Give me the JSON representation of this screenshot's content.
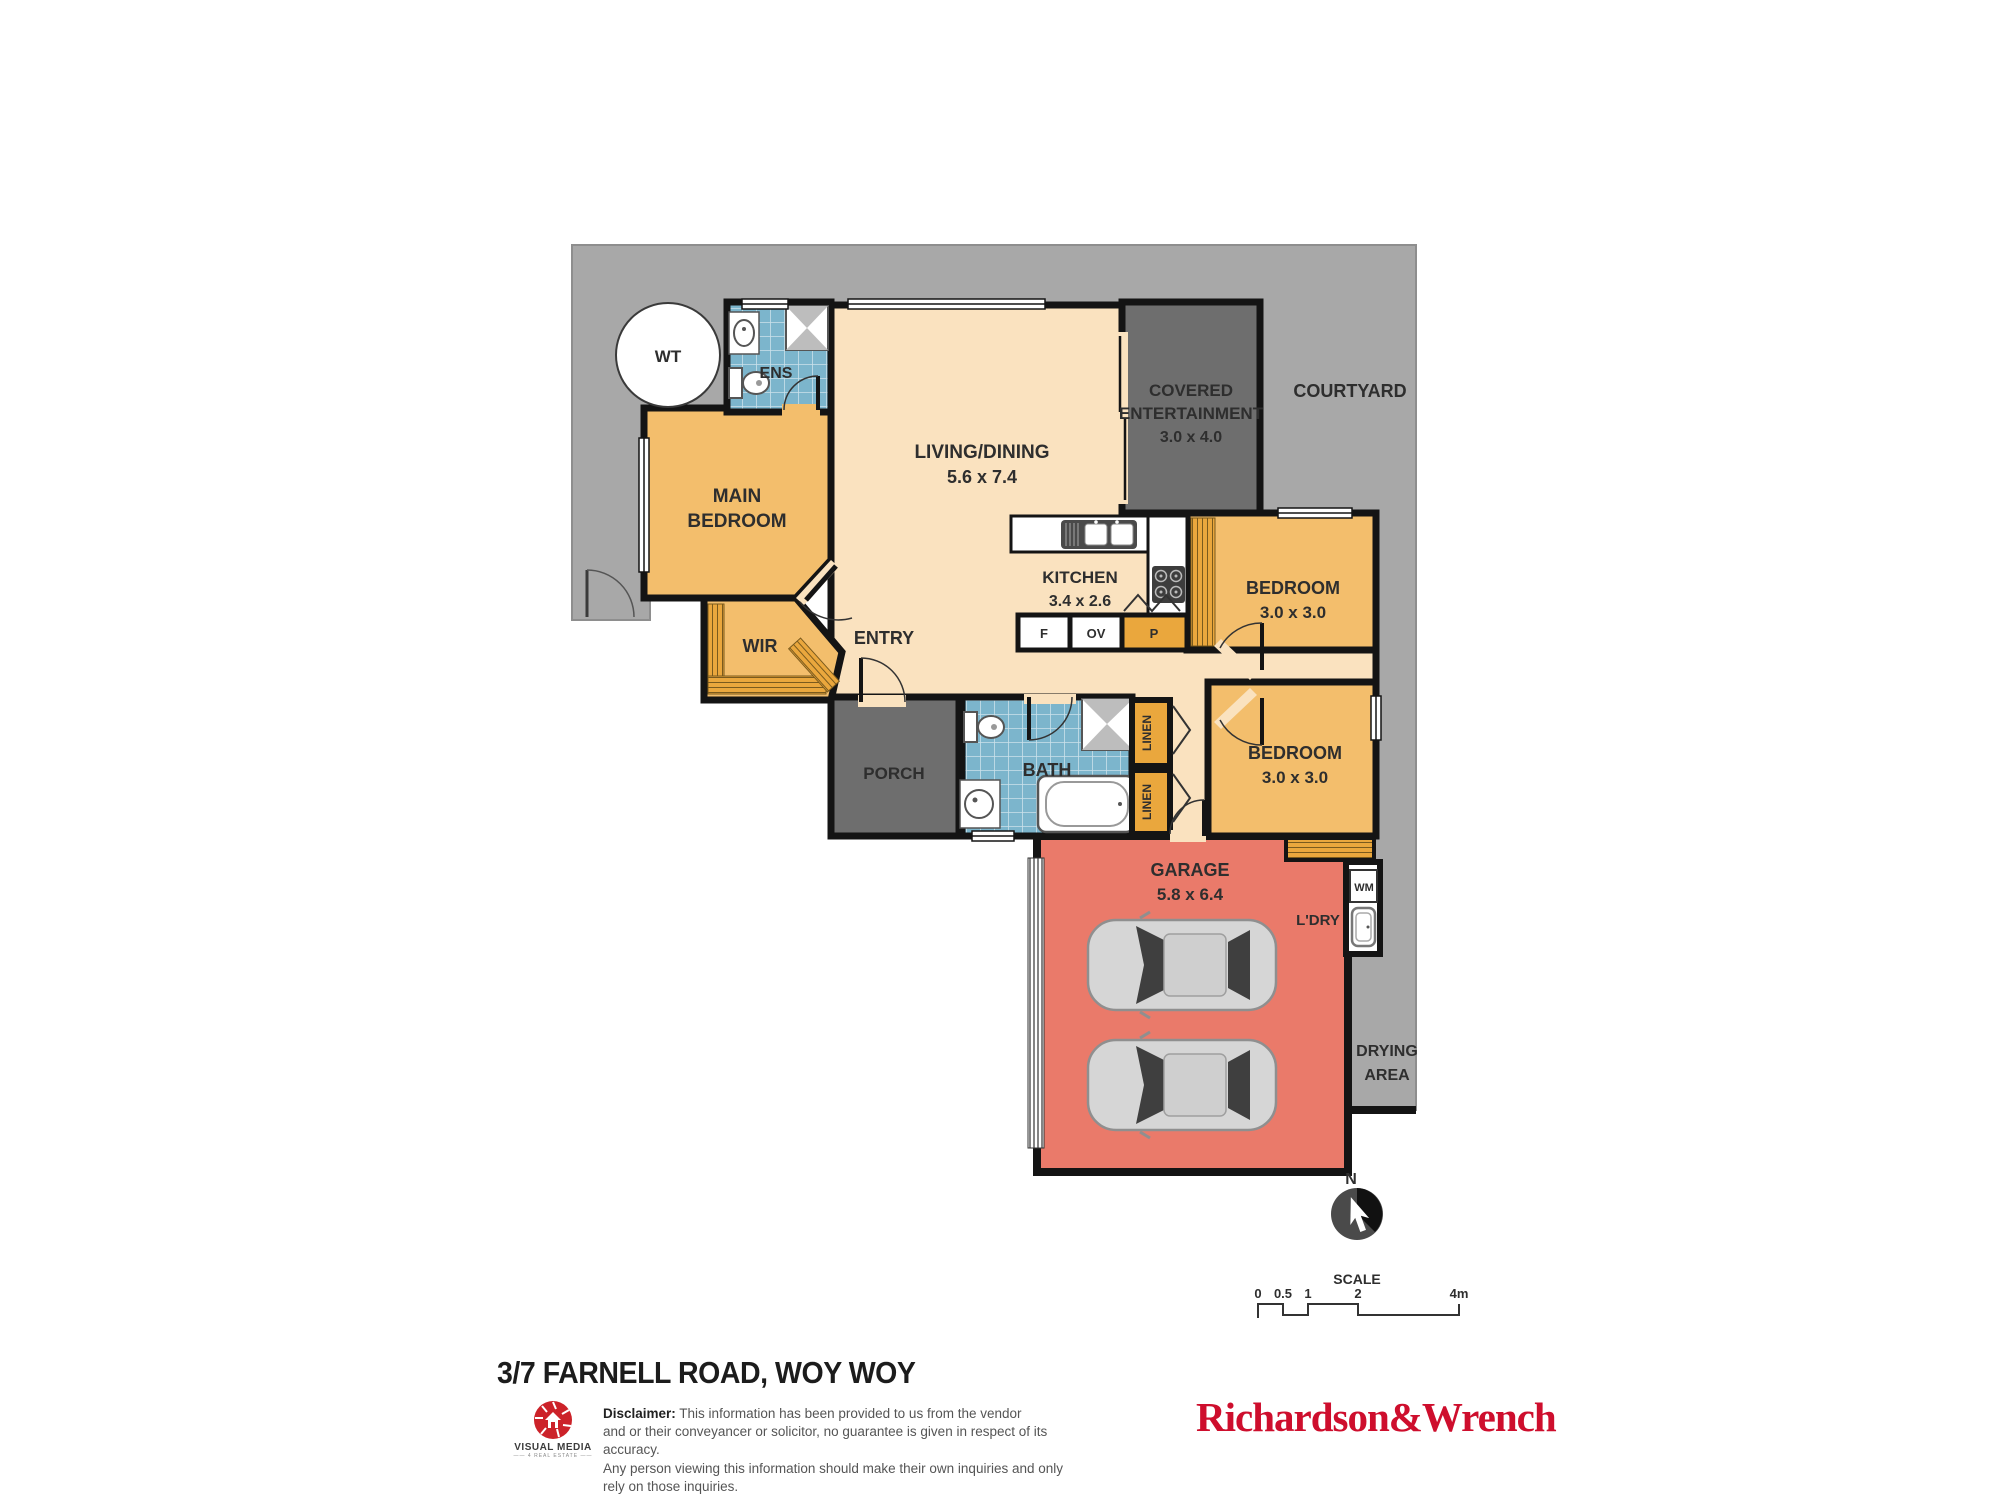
{
  "colors": {
    "courtyard_gray": "#a8a8a8",
    "covered_gray": "#6e6e6e",
    "interior_cream": "#fae2bf",
    "room_orange": "#f3be6c",
    "closet_orange": "#eaa73d",
    "wet_area_blue": "#7cb5cc",
    "garage_red": "#ea7a6a",
    "wall_black": "#141414",
    "brand_red": "#ce0e2d",
    "logo_red": "#cc2229"
  },
  "plan": {
    "wt": "WT",
    "ens": "ENS",
    "main_bedroom": {
      "l1": "MAIN",
      "l2": "BEDROOM"
    },
    "living": {
      "label": "LIVING/DINING",
      "dim": "5.6 x 7.4"
    },
    "covered": {
      "l1": "COVERED",
      "l2": "ENTERTAINMENT",
      "dim": "3.0 x 4.0"
    },
    "courtyard": "COURTYARD",
    "kitchen": {
      "label": "KITCHEN",
      "dim": "3.4 x 2.6",
      "fridge": "F",
      "oven": "OV",
      "pantry": "P"
    },
    "entry": "ENTRY",
    "wir": "WIR",
    "bedroom1": {
      "label": "BEDROOM",
      "dim": "3.0 x 3.0"
    },
    "bedroom2": {
      "label": "BEDROOM",
      "dim": "3.0 x 3.0"
    },
    "bath": "BATH",
    "linen1": "LINEN",
    "linen2": "LINEN",
    "porch": "PORCH",
    "garage": {
      "label": "GARAGE",
      "dim": "5.8 x 6.4"
    },
    "laundry": {
      "label": "L'DRY",
      "wm": "WM"
    },
    "drying": {
      "l1": "DRYING",
      "l2": "AREA"
    },
    "north": "N",
    "scale": {
      "title": "SCALE",
      "ticks": [
        "0",
        "0.5",
        "1",
        "2",
        "4m"
      ]
    }
  },
  "footer": {
    "address": "3/7 FARNELL ROAD, WOY WOY",
    "logo": {
      "name": "VISUAL MEDIA",
      "sub": "4 REAL ESTATE"
    },
    "disclaimer": {
      "heading": "Disclaimer:",
      "l1": " This information has been provided to us from the vendor",
      "l2": "and or their conveyancer or solicitor, no guarantee is given in respect of its accuracy.",
      "l3": "Any person viewing this information should make their own inquiries and only rely on those inquiries."
    },
    "agency": "Richardson&Wrench"
  }
}
